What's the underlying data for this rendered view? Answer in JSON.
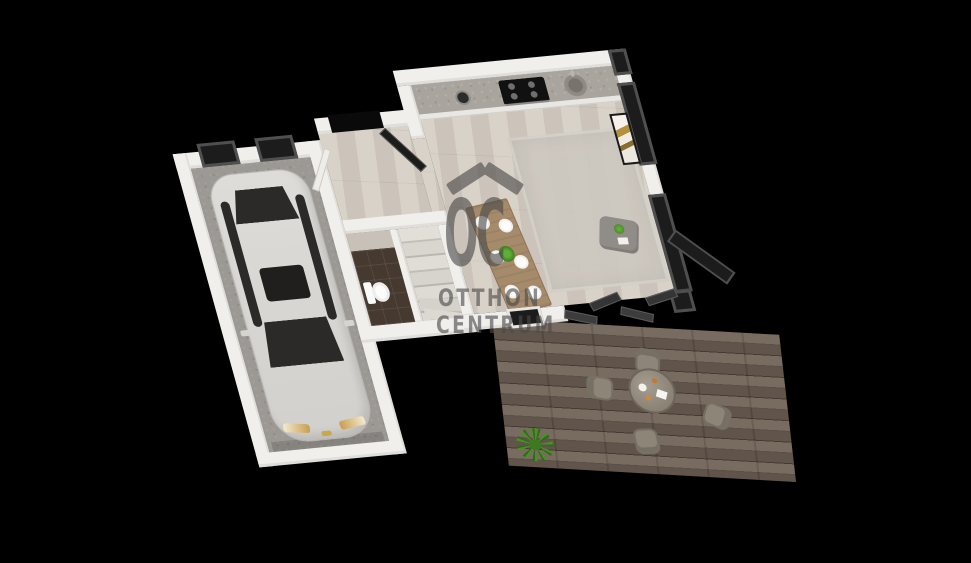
{
  "scene": {
    "description": "3D rendered floor plan of a house ground floor viewed from above on a black background",
    "view": "top-down perspective render"
  },
  "watermark": {
    "logo_monogram": "OC",
    "brand_line1": "OTTHON",
    "brand_line2": "CENTRUM",
    "roof_icon": "house-roof"
  },
  "rooms": [
    {
      "name": "garage",
      "floor": "concrete",
      "items": [
        "white-car",
        "two-dark-windows",
        "garage-door-opening"
      ]
    },
    {
      "name": "entry-hall",
      "floor": "wood",
      "items": [
        "open-front-door"
      ]
    },
    {
      "name": "wc",
      "floor": "dark-tile",
      "items": [
        "toilet"
      ]
    },
    {
      "name": "staircase",
      "items": [
        "winder-stairs"
      ]
    },
    {
      "name": "kitchen-living-room",
      "floor": "wood",
      "items": [
        "kitchen-counter",
        "cooktop",
        "round-sink",
        "dining-table",
        "dining-chairs-x6",
        "plates-x6",
        "corner-sofa",
        "pillows",
        "coffee-table",
        "area-rug",
        "gold-wall-art",
        "glass-wall",
        "folding-terrace-door",
        "bottom-window"
      ]
    },
    {
      "name": "terrace",
      "floor": "dark-wood-decking",
      "items": [
        "round-outdoor-table",
        "outdoor-chairs-x4",
        "green-plant"
      ]
    }
  ],
  "counts": {
    "dining_chairs": 6,
    "dining_plates": 6,
    "outdoor_chairs": 4,
    "cooktop_burners": 4,
    "garage_windows": 2
  },
  "colors": {
    "bg": "#000000",
    "wall": "#f1efec",
    "concrete": "#9c9994",
    "wood_floor": "#d5cdc2",
    "deck": "#6e6054",
    "tile": "#46392f",
    "glass": "#1c1c1c",
    "frame": "#4f4f4f",
    "sofa": "#f6f4f0",
    "pillow": "#ece4cf",
    "rug": "#cdc8c0",
    "table_wood": "#a68b6b",
    "chair": "#e7e4df",
    "car_body": "#d8d6d2",
    "car_glass": "#2b2a28",
    "counter": "#a9a59e",
    "cooktop": "#111111",
    "gold": "#b5913f",
    "plant": "#4c8f27",
    "watermark": "#4a4a4a"
  }
}
